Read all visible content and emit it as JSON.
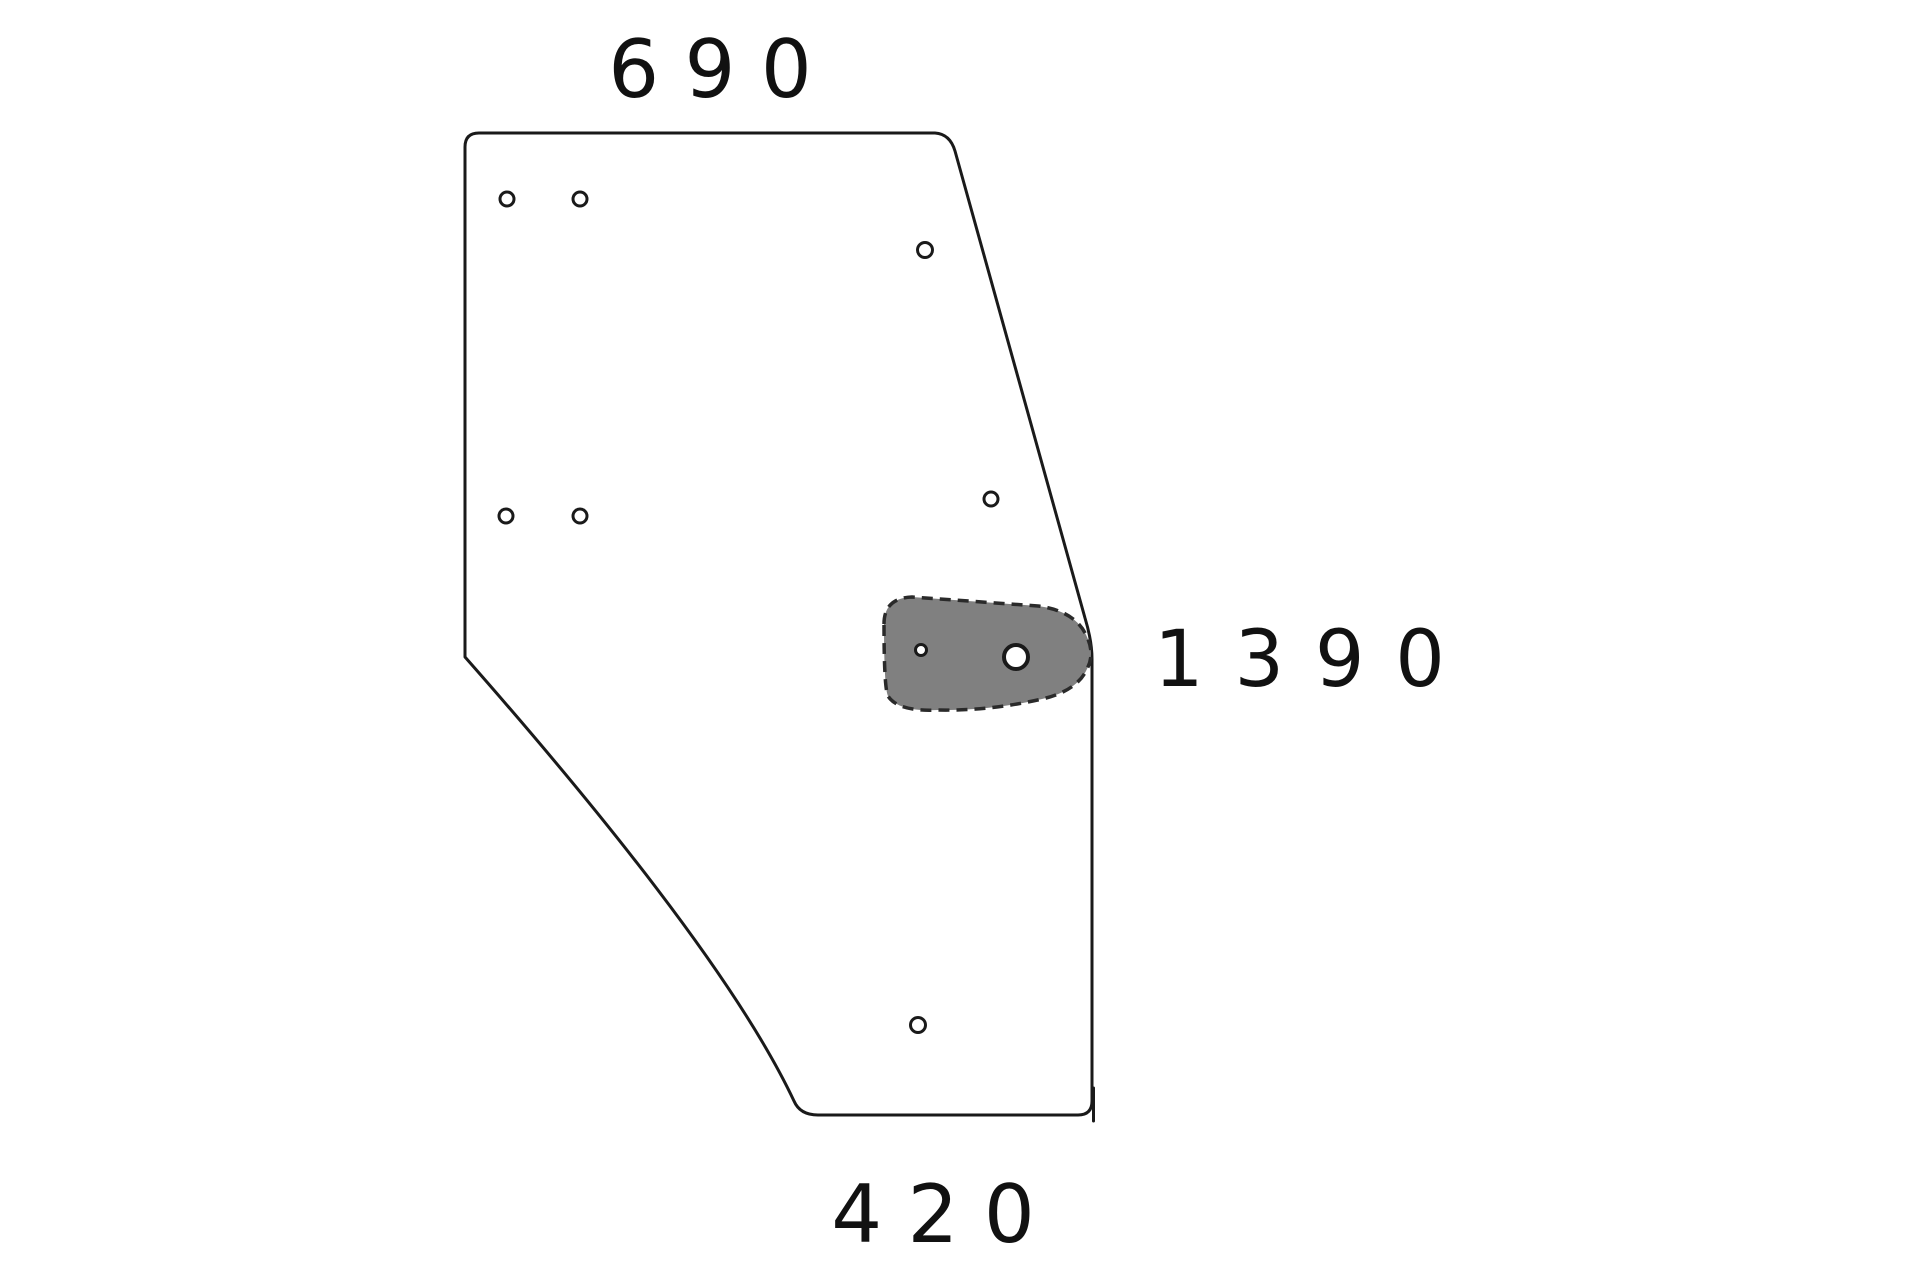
{
  "diagram": {
    "kind": "technical-part-drawing",
    "dimension_labels": {
      "top": {
        "text": "6 9 0",
        "value": 690
      },
      "right": {
        "text": "1 3 9 0",
        "value": 1390
      },
      "bottom": {
        "text": "4 2 0",
        "value": 420
      }
    },
    "colors": {
      "background": "#ffffff",
      "line": "#1a1a1a",
      "text": "#111111",
      "pad_fill": "#808080",
      "pad_stroke": "#2a2a2a"
    },
    "panel_holes": [
      {
        "cx": 507,
        "cy": 199,
        "r": 7,
        "sw": 3
      },
      {
        "cx": 580,
        "cy": 199,
        "r": 7,
        "sw": 3
      },
      {
        "cx": 925,
        "cy": 250,
        "r": 7.5,
        "sw": 3
      },
      {
        "cx": 506,
        "cy": 516,
        "r": 7,
        "sw": 3
      },
      {
        "cx": 580,
        "cy": 516,
        "r": 7,
        "sw": 3
      },
      {
        "cx": 991,
        "cy": 499,
        "r": 7,
        "sw": 3
      },
      {
        "cx": 918,
        "cy": 1025,
        "r": 7.5,
        "sw": 3
      }
    ],
    "pad_holes": [
      {
        "cx": 921,
        "cy": 650,
        "r": 5.5,
        "sw": 3
      },
      {
        "cx": 1016,
        "cy": 657,
        "r": 12,
        "sw": 4
      }
    ]
  }
}
